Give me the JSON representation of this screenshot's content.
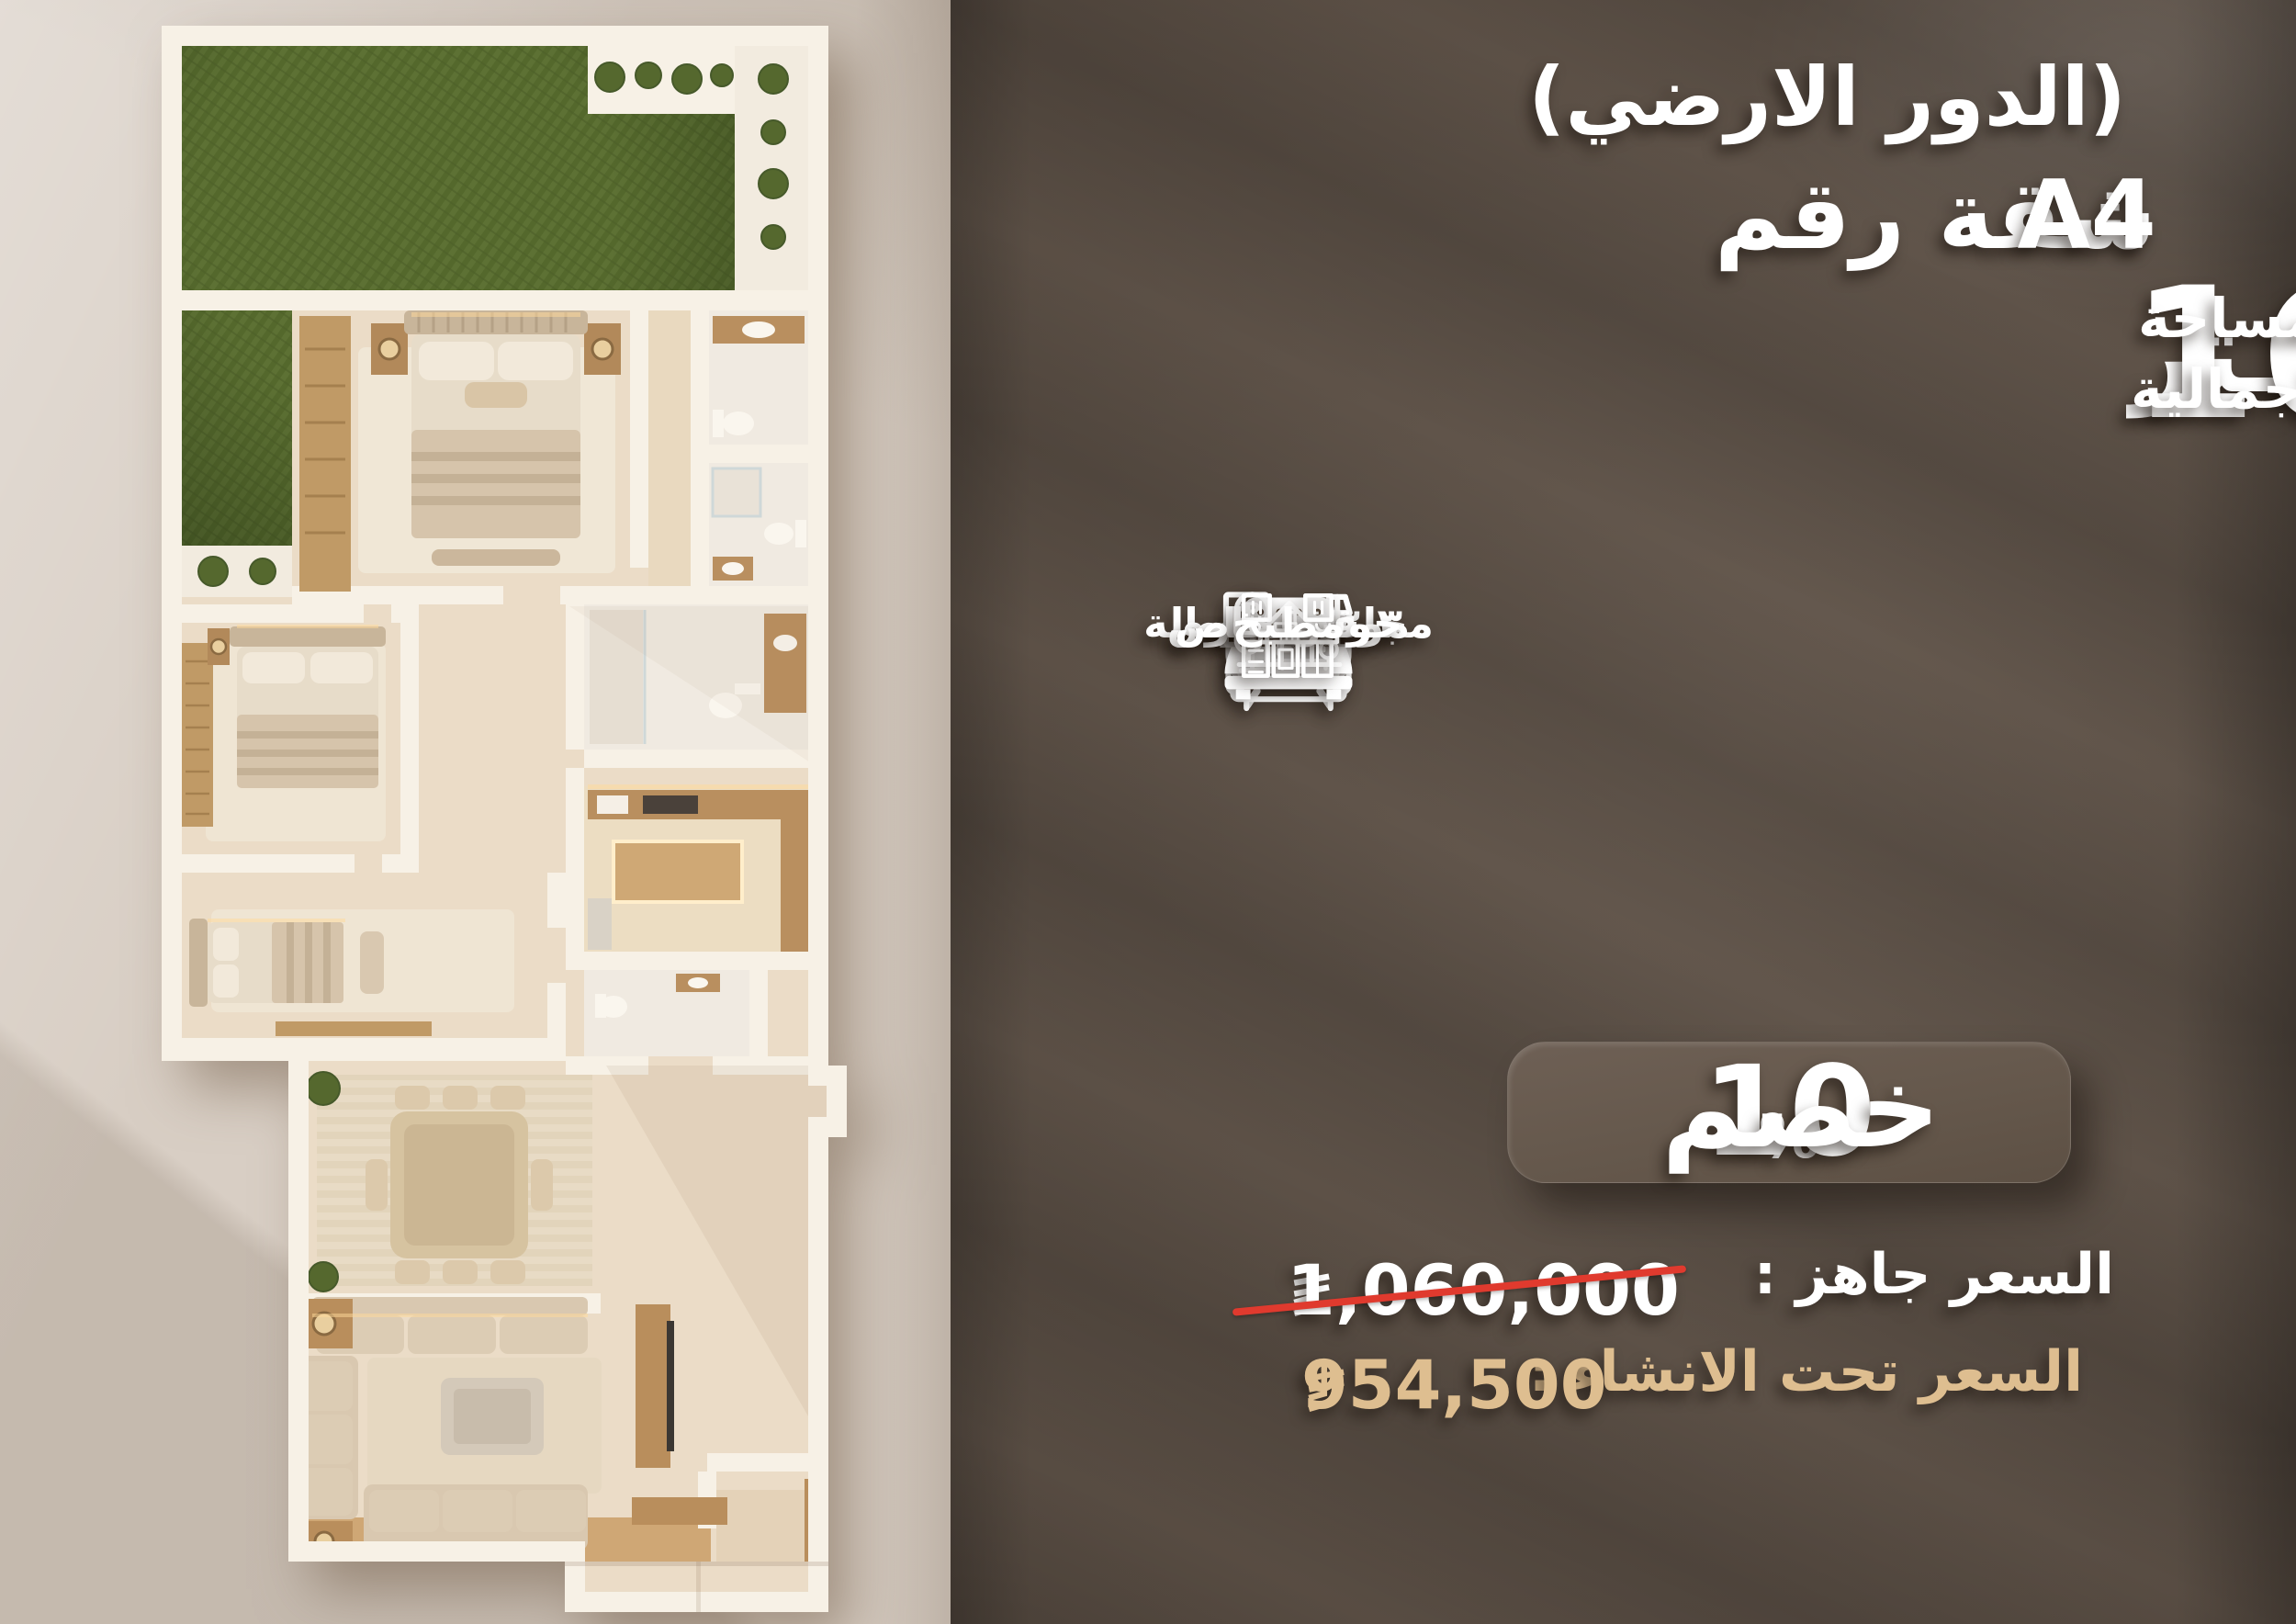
{
  "header": {
    "floor_label": "(الدور الارضي)",
    "unit_label": "شقة رقم",
    "unit_number": "A4"
  },
  "area": {
    "label_line1": "المساحة",
    "label_line2": "الاجمالية",
    "value": "166",
    "unit": "مـتر"
  },
  "features": [
    {
      "icon": "bathtub-icon",
      "label": "٣ حمام"
    },
    {
      "icon": "sofa-icon",
      "label": "مجلس + صالة"
    },
    {
      "icon": "bed-icon",
      "label": "٣ غرف نوم"
    },
    {
      "icon": "parking-icon",
      "label": "موقف خاص",
      "sign_letter": "P"
    },
    {
      "icon": "yard-icon",
      "label": "حوش خاص"
    },
    {
      "icon": "kitchen-icon",
      "label": "مطبخ"
    }
  ],
  "discount": {
    "word": "خصم",
    "value": "10",
    "percent": "%"
  },
  "prices": [
    {
      "label": "السعر جاهز :",
      "value": "1,060,000",
      "currency": "saudi-riyal-symbol",
      "strikethrough": true
    },
    {
      "label": "السعر تحت الانشاء :",
      "value": "954,500",
      "currency": "saudi-riyal-symbol",
      "strikethrough": false
    }
  ],
  "colors": {
    "panel_bg": "#5e5146",
    "text_white": "#ffffff",
    "text_gold": "#debe90",
    "strike_red": "#e03a2e",
    "left_bg": "#d8cec4",
    "grass_green": "#5d7134",
    "wall_white": "#f7f1e6",
    "floor_beige": "#ebdcc7",
    "wood": "#bb9160"
  },
  "floorplan": {
    "rooms": [
      "garden",
      "master-bedroom",
      "bedroom-2",
      "bedroom-3",
      "bathroom-1",
      "bathroom-2",
      "bathroom-3",
      "wc",
      "kitchen",
      "dining-room",
      "living-room",
      "entrance"
    ]
  }
}
